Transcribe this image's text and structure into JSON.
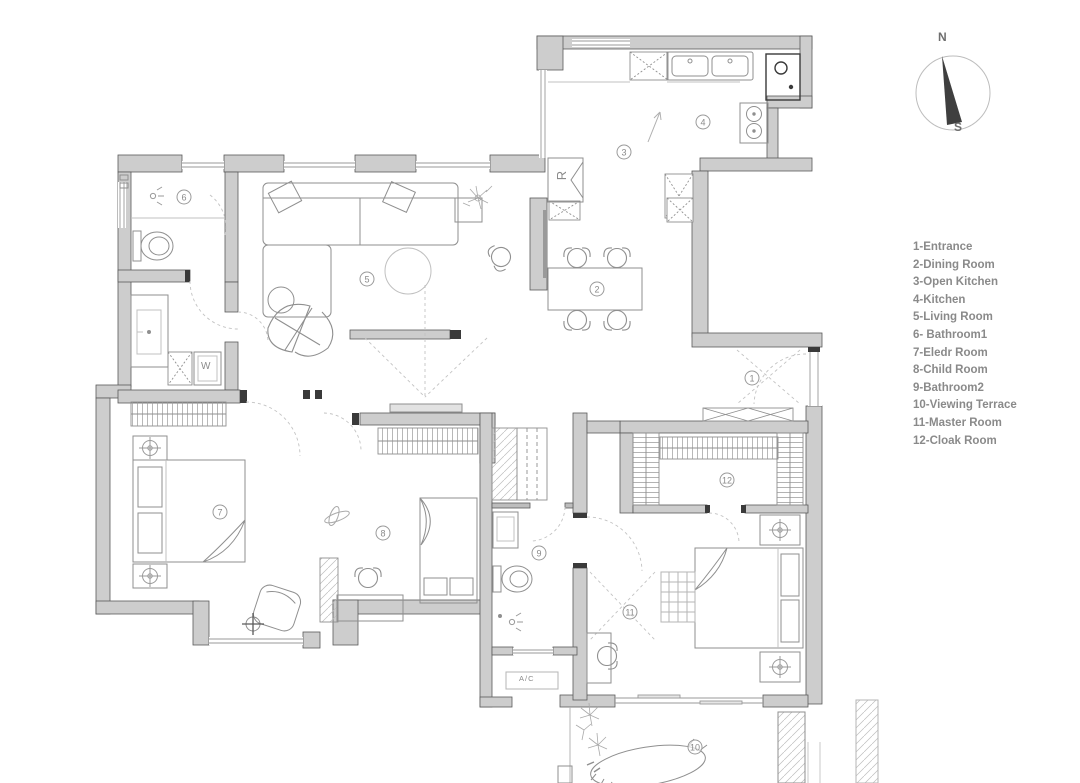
{
  "compass": {
    "north": "N",
    "south": "S"
  },
  "legend": {
    "items": [
      "1-Entrance",
      "2-Dining Room",
      "3-Open Kitchen",
      "4-Kitchen",
      "5-Living Room",
      "6- Bathroom1",
      "7-Eledr Room",
      "8-Child Room",
      "9-Bathroom2",
      "10-Viewing Terrace",
      "11-Master Room",
      "12-Cloak Room"
    ]
  },
  "rooms": [
    {
      "number": "1",
      "name": "Entrance"
    },
    {
      "number": "2",
      "name": "Dining Room"
    },
    {
      "number": "3",
      "name": "Open Kitchen"
    },
    {
      "number": "4",
      "name": "Kitchen"
    },
    {
      "number": "5",
      "name": "Living Room"
    },
    {
      "number": "6",
      "name": "Bathroom1"
    },
    {
      "number": "7",
      "name": "Eledr Room"
    },
    {
      "number": "8",
      "name": "Child Room"
    },
    {
      "number": "9",
      "name": "Bathroom2"
    },
    {
      "number": "10",
      "name": "Viewing Terrace"
    },
    {
      "number": "11",
      "name": "Master Room"
    },
    {
      "number": "12",
      "name": "Cloak Room"
    }
  ],
  "labels": {
    "fridge": "R",
    "washer": "W",
    "ac": "A/C"
  },
  "colors": {
    "wall_fill": "#cdcdcd",
    "wall_stroke": "#5a5a5a",
    "furniture_line": "#8f8f8f",
    "light_line": "#b5b5b5",
    "cap_dark": "#3a3a3a",
    "text_gray": "#8a8a8a",
    "needle": "#3f3f3f"
  }
}
